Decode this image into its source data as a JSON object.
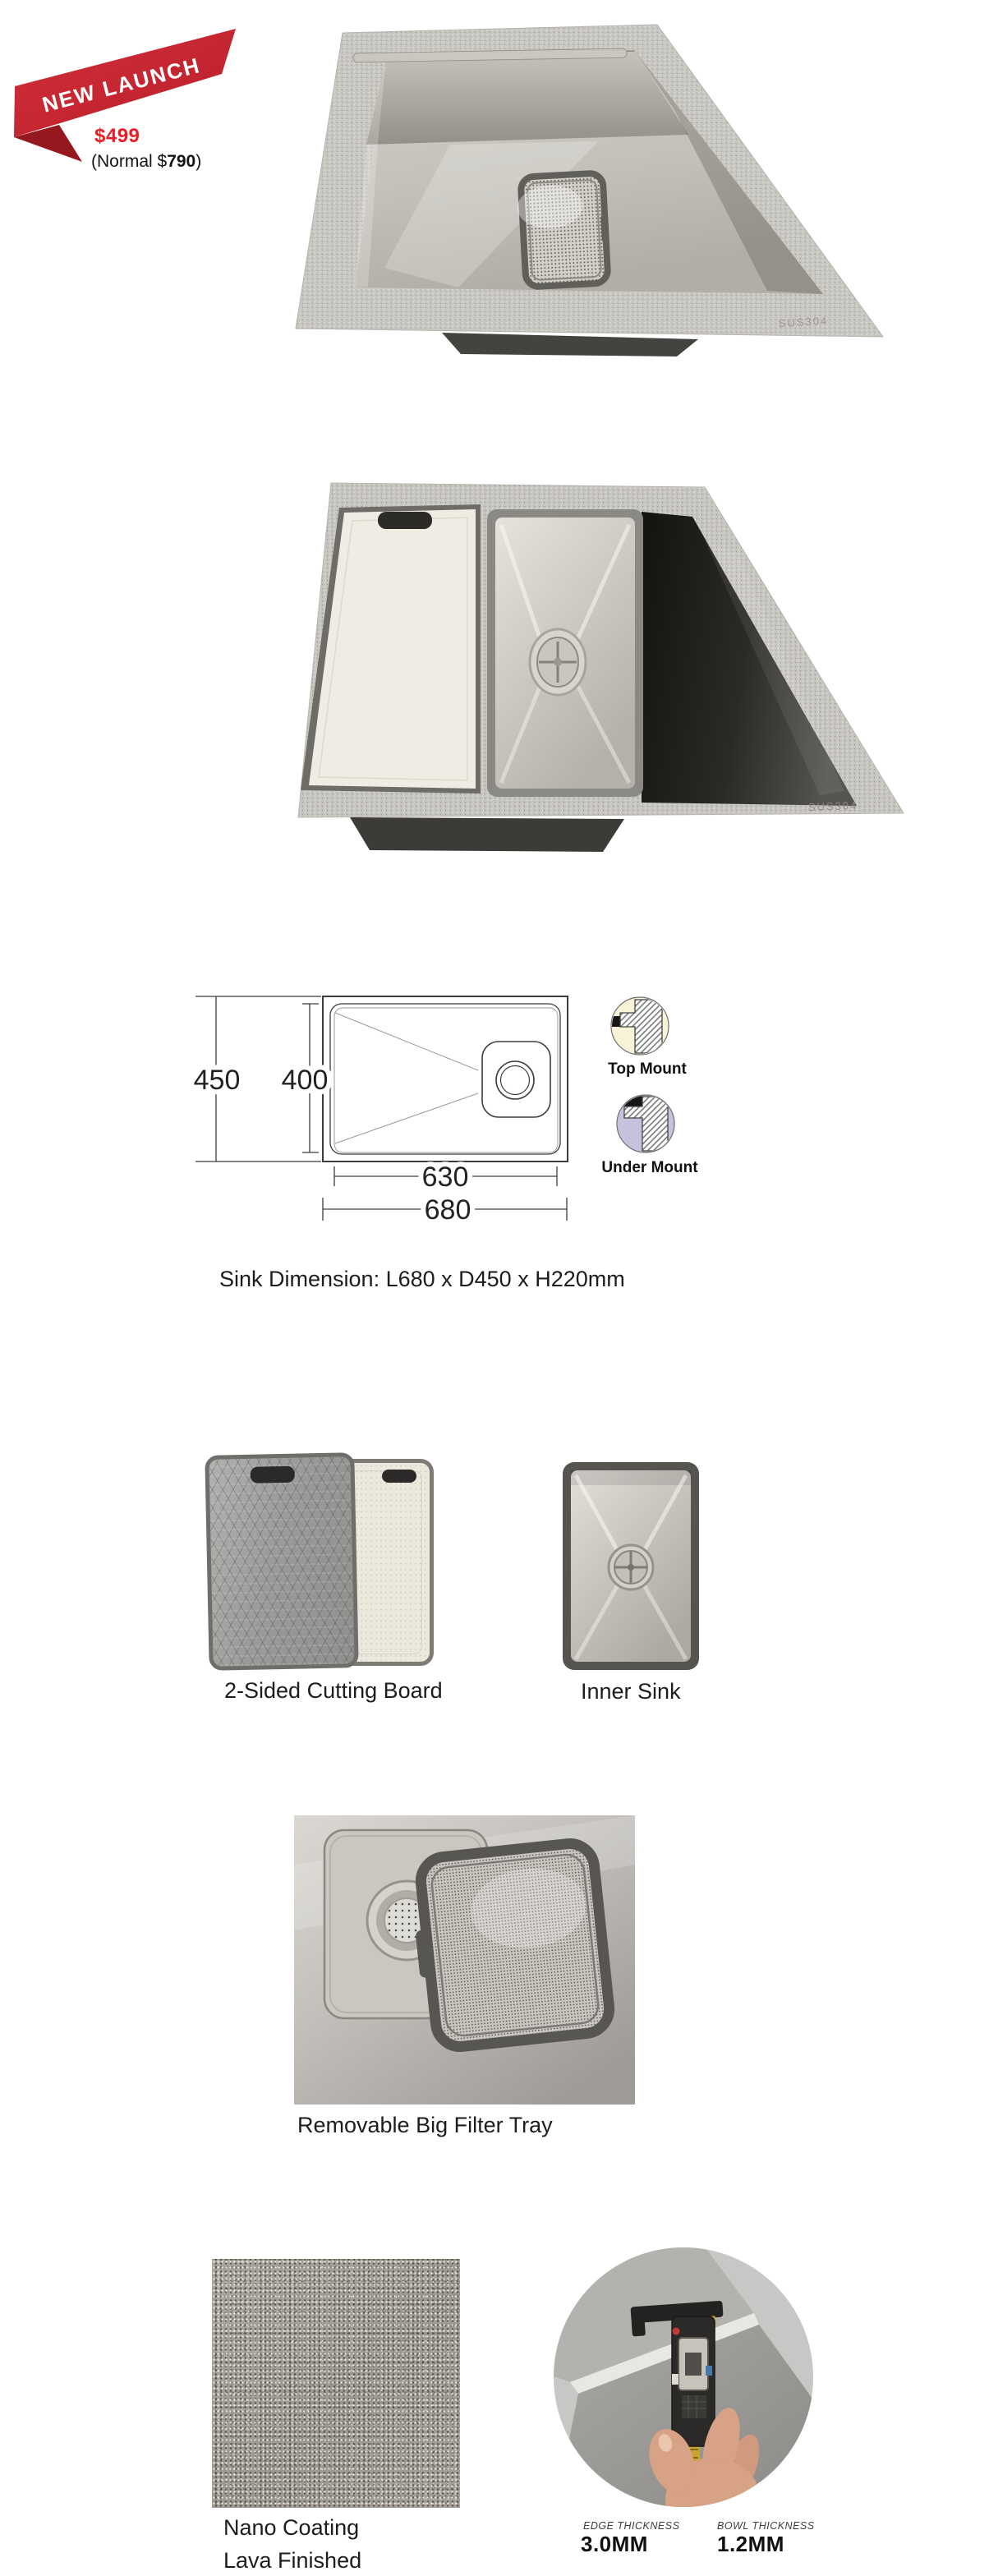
{
  "badge": {
    "ribbon_text": "NEW LAUNCH",
    "price": "$499",
    "normal_price_prefix": "(Normal $",
    "normal_price_value": "790",
    "normal_price_suffix": ")"
  },
  "product": {
    "engraving": "SUS304"
  },
  "diagram": {
    "overall_depth": "450",
    "inner_depth": "400",
    "inner_length": "630",
    "overall_length": "680",
    "mount_options": [
      {
        "label": "Top Mount"
      },
      {
        "label": "Under Mount"
      }
    ]
  },
  "dimension_note": "Sink Dimension: L680 x D450 x H220mm",
  "features": {
    "cutting_board_caption": "2-Sided Cutting Board",
    "inner_sink_caption": "Inner Sink",
    "filter_tray_caption": "Removable Big Filter Tray",
    "coating_caption_line1": "Nano Coating",
    "coating_caption_line2": "Lava Finished"
  },
  "thickness": {
    "edge_label": "EDGE THICKNESS",
    "edge_value": "3.0MM",
    "bowl_label": "BOWL THICKNESS",
    "bowl_value": "1.2MM"
  },
  "colors": {
    "ribbon_red": "#c9242e",
    "ribbon_fold_red": "#96181f",
    "price_red": "#ee1c25",
    "text_black": "#1d1d1b",
    "diagram_line": "#3c3c3c",
    "top_mount_fill": "#f6f3d7",
    "under_mount_fill": "#c5c2de"
  }
}
